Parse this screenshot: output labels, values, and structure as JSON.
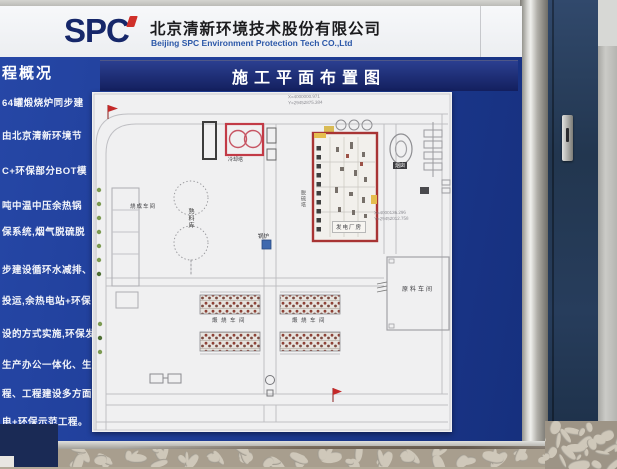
{
  "header": {
    "logo": "SPC",
    "company_cn": "北京清新环境技术股份有限公司",
    "company_en": "Beijing SPC Environment Protection Tech CO.,Ltd"
  },
  "sidebar": {
    "heading": "程概况",
    "lines": [
      "64罐煅烧炉同步建",
      "由北京清新环境节",
      "C+环保部分BOT模",
      "吨中温中压余热锅",
      "保系统,烟气脱硫脱",
      "步建设循环水减排、脱",
      "投运,余热电站+环保",
      "设的方式实施,环保发",
      "生产办公一体化、生产",
      "程、工程建设多方面树立",
      "电+环保示范工程。"
    ]
  },
  "plan": {
    "title": "施工平面布置图",
    "coords_top": {
      "x": "X=4000000.971",
      "y": "Y=29452875.384"
    },
    "coords_right": {
      "x": "X=4000136.296",
      "y": "Y=29452012.758"
    },
    "labels": {
      "cooling_tower": "冷却塔",
      "clinker_silo": "熟料库",
      "firing_workshop": "烧成车间",
      "boiler": "锅炉",
      "desulfurization": "脱硫塔",
      "power_house": "发电厂房",
      "chimney": "烟囱",
      "calcining_left": "煅烧车间",
      "calcining_right": "煅烧车间",
      "raw_material": "原料车间"
    }
  },
  "colors": {
    "board_blue": "#1e3c96",
    "title_navy": "#18276f",
    "logo_navy": "#16276a",
    "company_en_blue": "#2b57a8",
    "plan_red": "#a83434",
    "flag_red": "#c42828"
  }
}
